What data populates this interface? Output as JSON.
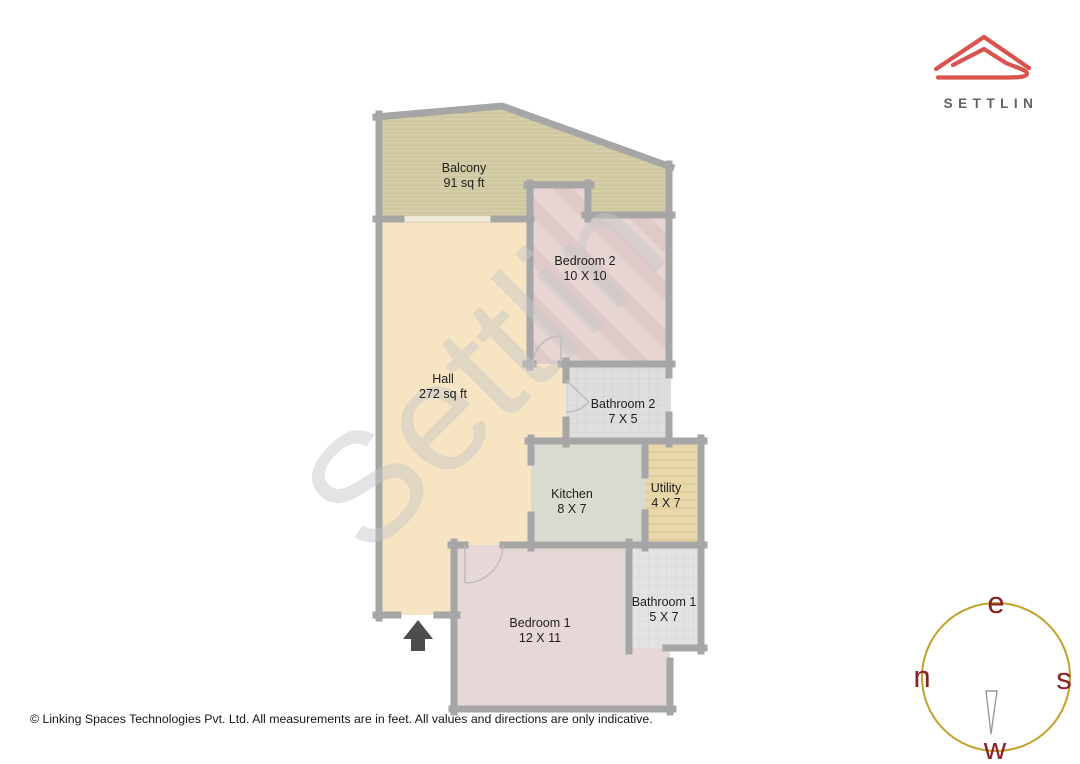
{
  "brand": {
    "name": "SETTLIN",
    "logo_color": "#d9534f",
    "text_color": "#5d6166"
  },
  "plan": {
    "watermark": "Settlin",
    "wall_color": "#a6a6a6",
    "watermark_color": "#c7c7c7",
    "entrance_arrow_color": "#4d4d4d",
    "rooms": {
      "balcony": {
        "name": "Balcony",
        "size": "91 sq ft",
        "color": "#d8d2ac"
      },
      "bedroom2": {
        "name": "Bedroom 2",
        "size": "10 X 10",
        "color": "#e7d5d3"
      },
      "hall": {
        "name": "Hall",
        "size": "272 sq ft",
        "color": "#f7e4c2"
      },
      "bathroom2": {
        "name": "Bathroom 2",
        "size": "7 X 5",
        "color": "#dedede"
      },
      "kitchen": {
        "name": "Kitchen",
        "size": "8 X 7",
        "color": "#d7dbd0"
      },
      "utility": {
        "name": "Utility",
        "size": "4 X 7",
        "color": "#e8d7ab"
      },
      "bedroom1": {
        "name": "Bedroom 1",
        "size": "12 X 11",
        "color": "#e6d8d6"
      },
      "bathroom1": {
        "name": "Bathroom 1",
        "size": "5 X 7",
        "color": "#e3e3e3"
      }
    }
  },
  "compass": {
    "top": "e",
    "left": "n",
    "right": "s",
    "bottom": "w",
    "ring_color": "#c2a12c",
    "letter_color": "#8b2121"
  },
  "footer": {
    "text": "© Linking Spaces Technologies Pvt. Ltd. All measurements are in feet. All values and directions are only indicative."
  }
}
